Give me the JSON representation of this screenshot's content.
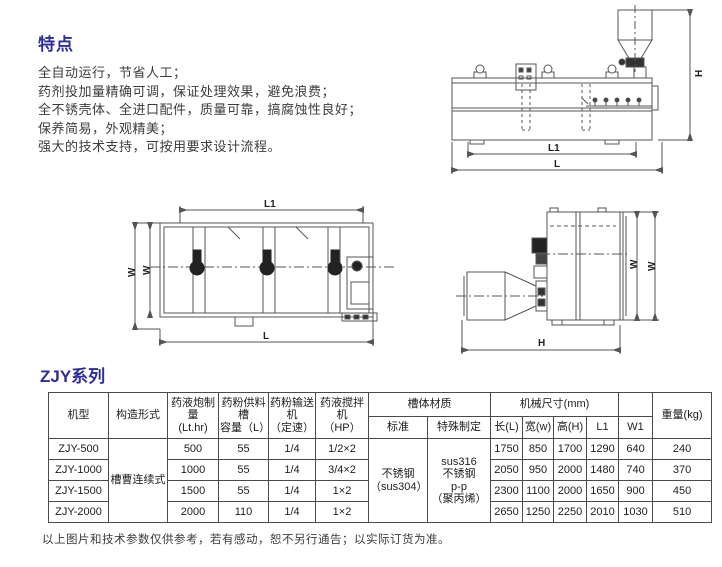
{
  "page": {
    "features_title": "特点",
    "features": [
      "全自动运行，节省人工；",
      "药剂投加量精确可调，保证处理效果，避免浪费；",
      "全不锈壳体、全进口配件，质量可靠，搞腐蚀性良好；",
      "保养简易，外观精美；",
      "强大的技术支持，可按用要求设计流程。"
    ],
    "series_title": "ZJY系列",
    "footnote": "以上图片和技术参数仅供参考，若有感动，恕不另行通告；以实际订货为准。"
  },
  "drawings": {
    "side_view": {
      "dim_l1": "L1",
      "dim_l": "L",
      "dim_h": "H"
    },
    "plan_view": {
      "dim_l1": "L1",
      "dim_l": "L",
      "dim_w_outer": "W",
      "dim_w_inner": "W"
    },
    "end_view": {
      "dim_w_outer": "W",
      "dim_w_inner": "W",
      "dim_h": "H"
    }
  },
  "table": {
    "headers": {
      "model": "机型",
      "construction": "构造形式",
      "dosing_capacity": "药液炮制\n量\n(Lt.hr)",
      "powder_tank": "药粉供料\n槽\n容量（L）",
      "powder_feeder": "药粉输送\n机\n（定速）",
      "mixer": "药液搅拌\n机\n（HP）",
      "tank_material": "槽体材质",
      "standard": "标准",
      "special": "特殊制定",
      "dimensions": "机械尺寸(mm)",
      "len": "长(L)",
      "width": "宽(w)",
      "height": "高(H)",
      "l1": "L1",
      "w1": "W1",
      "weight": "重量(kg)"
    },
    "merged": {
      "construction": "槽曹连续式",
      "standard_material": "不锈钢\n（sus304）",
      "special_material": "sus316\n不锈钢\np-p\n（聚丙烯）"
    },
    "rows": [
      {
        "model": "ZJY-500",
        "capacity": "500",
        "tank": "55",
        "feeder": "1/4",
        "mixer": "1/2×2",
        "len": "1750",
        "width": "850",
        "height": "1700",
        "l1": "1290",
        "w1": "640",
        "weight": "240"
      },
      {
        "model": "ZJY-1000",
        "capacity": "1000",
        "tank": "55",
        "feeder": "1/4",
        "mixer": "3/4×2",
        "len": "2050",
        "width": "950",
        "height": "2000",
        "l1": "1480",
        "w1": "740",
        "weight": "370"
      },
      {
        "model": "ZJY-1500",
        "capacity": "1500",
        "tank": "55",
        "feeder": "1/4",
        "mixer": "1×2",
        "len": "2300",
        "width": "1100",
        "height": "2000",
        "l1": "1650",
        "w1": "900",
        "weight": "450"
      },
      {
        "model": "ZJY-2000",
        "capacity": "2000",
        "tank": "110",
        "feeder": "1/4",
        "mixer": "1×2",
        "len": "2650",
        "width": "1250",
        "height": "2250",
        "l1": "2010",
        "w1": "1030",
        "weight": "510"
      }
    ]
  }
}
